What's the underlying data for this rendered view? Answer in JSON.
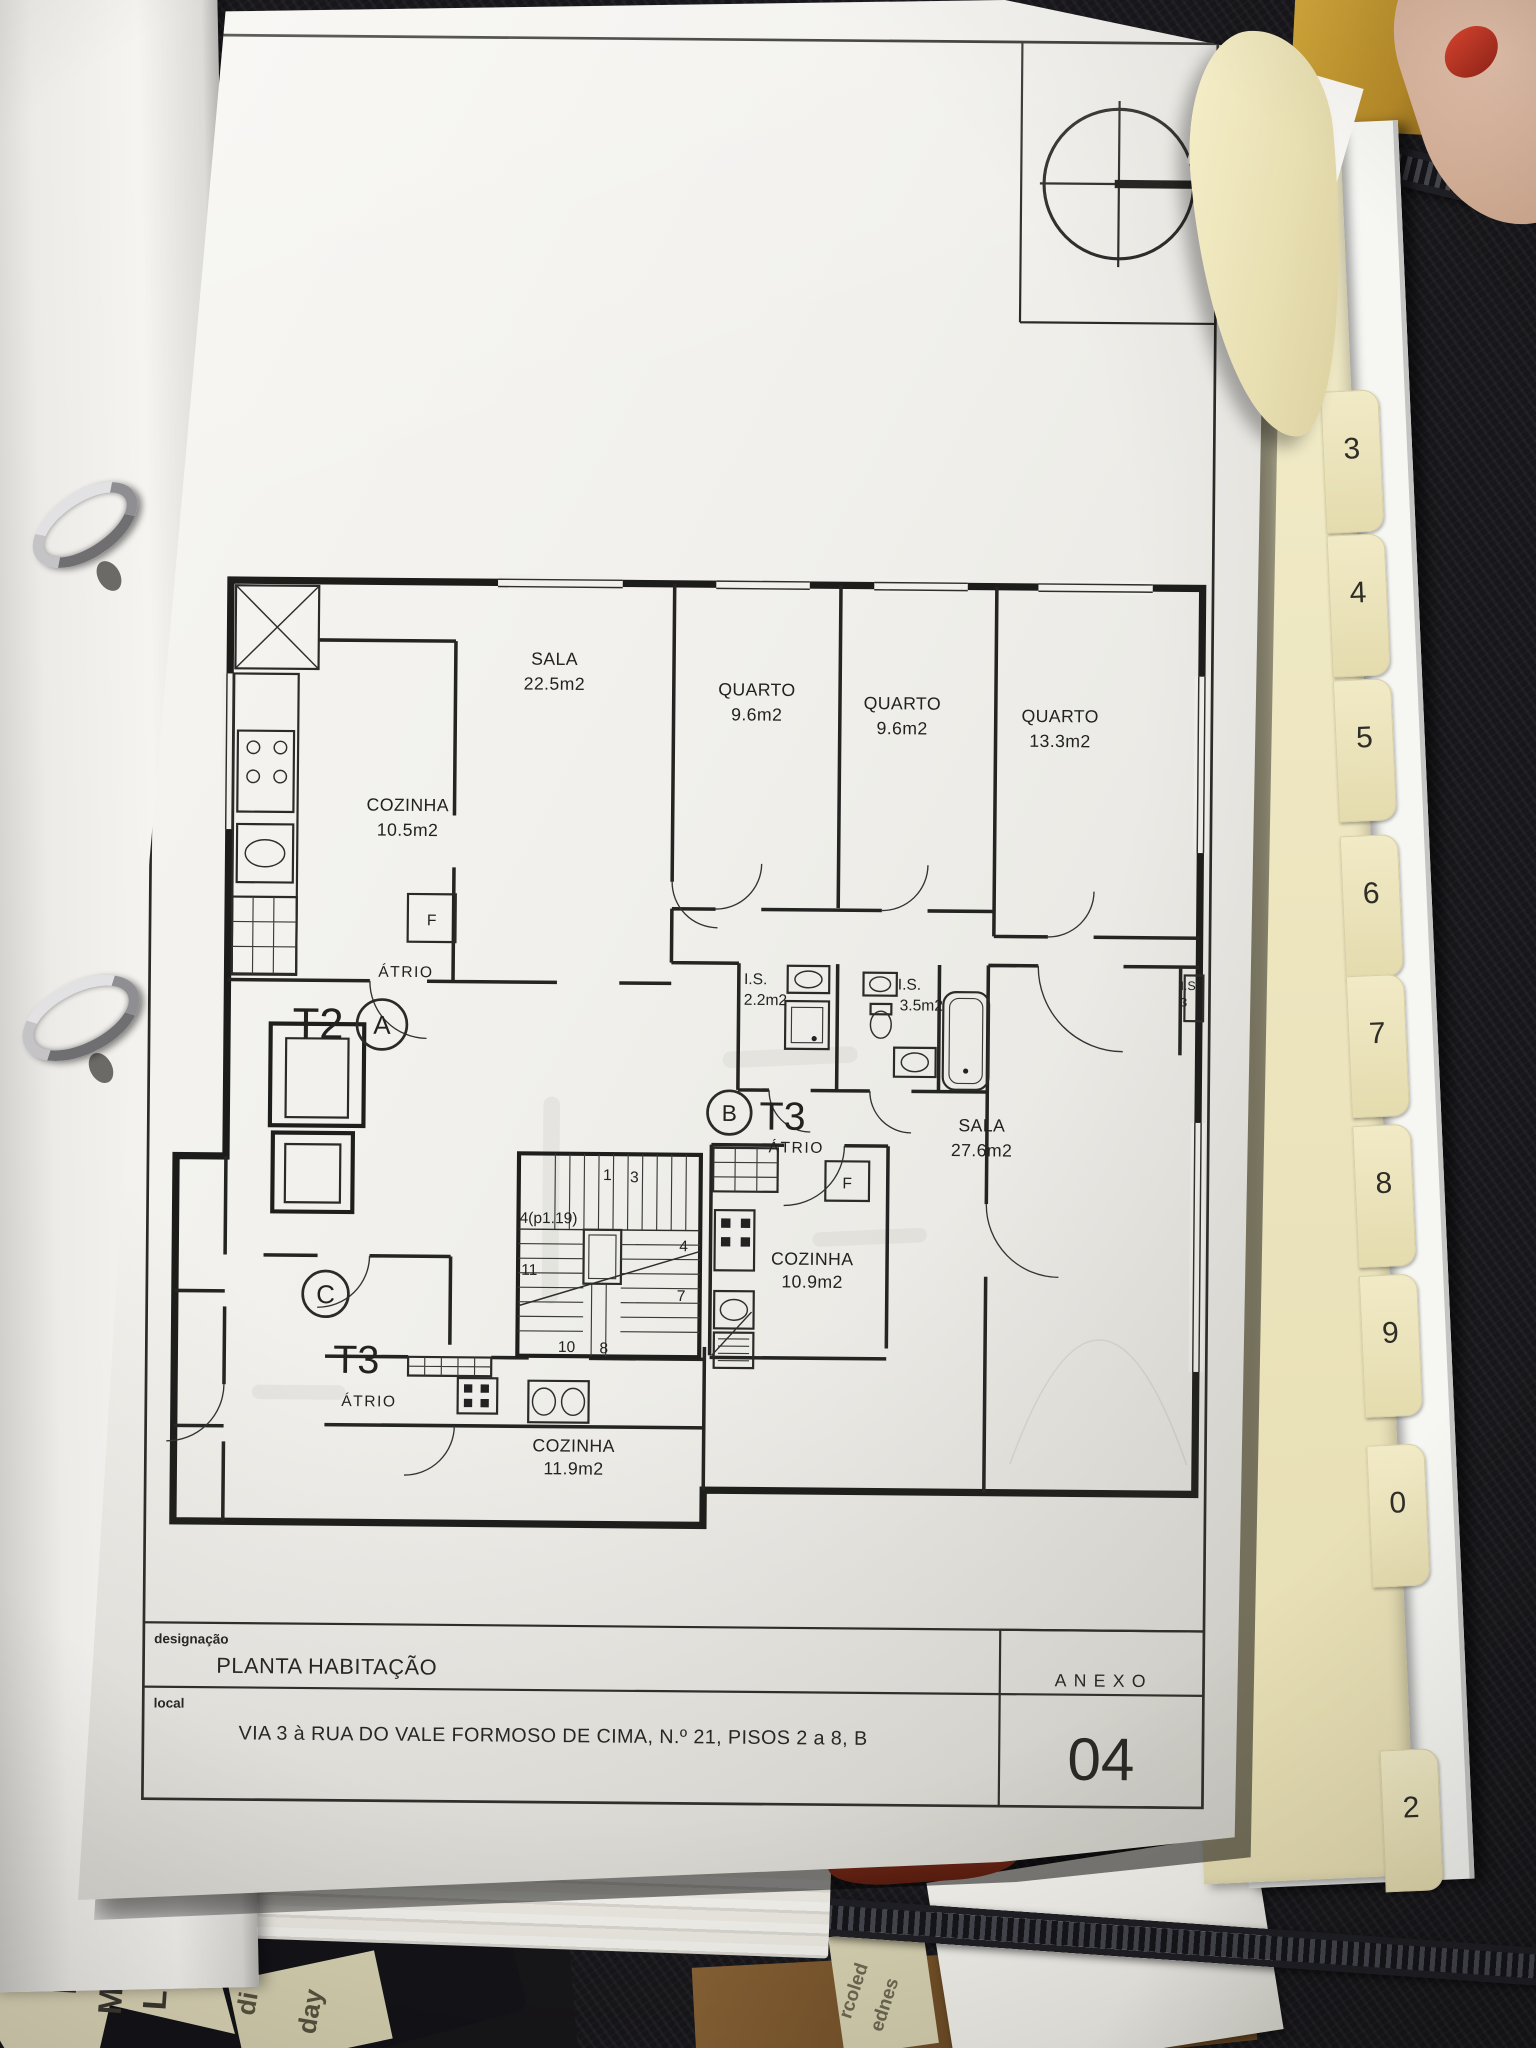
{
  "photo": {
    "binder_tabs": [
      "3",
      "4",
      "5",
      "6",
      "7",
      "8",
      "9",
      "0",
      "2"
    ],
    "planner_words": [
      "Lundi",
      "Montag",
      "Lunes"
    ],
    "planner_fragments": [
      "di",
      "day",
      "rcoled",
      "ednes"
    ],
    "colors": {
      "case": "#17161a",
      "divider_cream": "#efe8c3",
      "desk_wood": "#7d5a2e",
      "red_page_edge": "#c9472b"
    }
  },
  "plan": {
    "compass": "N",
    "units": {
      "a_type": "T2",
      "a_id": "A",
      "b_type": "T3",
      "b_id": "B",
      "c_type": "T3",
      "c_id": "C"
    },
    "labels": {
      "atrio": "ÁTRIO",
      "f": "F"
    },
    "rooms": {
      "sala_a": {
        "name": "SALA",
        "area": "22.5m2"
      },
      "quarto1": {
        "name": "QUARTO",
        "area": "9.6m2"
      },
      "quarto2": {
        "name": "QUARTO",
        "area": "9.6m2"
      },
      "quarto3": {
        "name": "QUARTO",
        "area": "13.3m2"
      },
      "cozinha_a": {
        "name": "COZINHA",
        "area": "10.5m2"
      },
      "is1": {
        "name": "I.S.",
        "area": "2.2m2"
      },
      "is2": {
        "name": "I.S.",
        "area": "3.5m2"
      },
      "is3": {
        "name": "I.S.",
        "area": "3"
      },
      "sala_b": {
        "name": "SALA",
        "area": "27.6m2"
      },
      "cozinha_b": {
        "name": "COZINHA",
        "area": "10.9m2"
      },
      "cozinha_c": {
        "name": "COZINHA",
        "area": "11.9m2"
      }
    },
    "stairs": {
      "n1": "1",
      "n3": "3",
      "p": "4(p1.19)",
      "n11": "11",
      "n4": "4",
      "n7": "7",
      "n10": "10",
      "n8": "8"
    },
    "title_block": {
      "designacao_label": "designação",
      "designacao_value": "PLANTA HABITAÇÃO",
      "local_label": "local",
      "local_value": "VIA 3 à RUA DO VALE FORMOSO DE CIMA, N.º 21, PISOS 2 a 8, B",
      "anexo_label": "ANEXO",
      "anexo_number": "04"
    }
  }
}
